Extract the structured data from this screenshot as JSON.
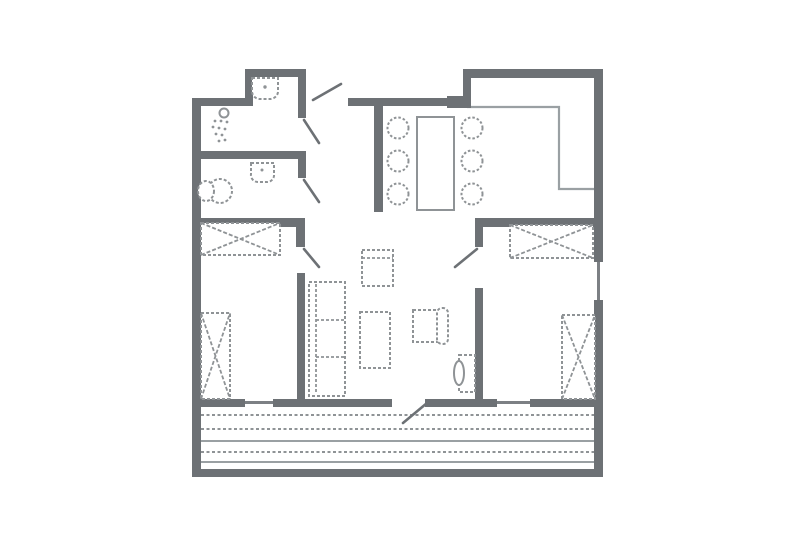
{
  "meta": {
    "title": "apartment-floor-plan",
    "canvas_width": 805,
    "canvas_height": 555,
    "background": "#ffffff"
  },
  "palette": {
    "wall": "#6d7175",
    "wall_light": "#7c8084",
    "furniture": "#8f9396",
    "thin": "#9aa0a3",
    "paper": "#ffffff"
  },
  "floorplan": {
    "walls": [
      {
        "name": "wall-exterior-left",
        "x": 192,
        "y": 98,
        "w": 9,
        "h": 379
      },
      {
        "name": "wall-top-left",
        "x": 192,
        "y": 98,
        "w": 56,
        "h": 8
      },
      {
        "name": "wall-bath-nook-left",
        "x": 245,
        "y": 69,
        "w": 8,
        "h": 37
      },
      {
        "name": "wall-bath-nook-top",
        "x": 245,
        "y": 69,
        "w": 61,
        "h": 8
      },
      {
        "name": "wall-bath-right-upper",
        "x": 298,
        "y": 69,
        "w": 8,
        "h": 49
      },
      {
        "name": "wall-shower-bottom",
        "x": 192,
        "y": 151,
        "w": 114,
        "h": 8
      },
      {
        "name": "wall-wc-right-stub",
        "x": 298,
        "y": 151,
        "w": 8,
        "h": 27
      },
      {
        "name": "wall-bedroom1-top",
        "x": 192,
        "y": 218,
        "w": 112,
        "h": 9
      },
      {
        "name": "wall-bedroom1-right-stub",
        "x": 296,
        "y": 218,
        "w": 9,
        "h": 29
      },
      {
        "name": "wall-living-west",
        "x": 297,
        "y": 273,
        "w": 8,
        "h": 132
      },
      {
        "name": "wall-hall-top",
        "x": 348,
        "y": 98,
        "w": 100,
        "h": 8
      },
      {
        "name": "wall-hall-top-block",
        "x": 447,
        "y": 96,
        "w": 21,
        "h": 12
      },
      {
        "name": "wall-hall-dining",
        "x": 374,
        "y": 98,
        "w": 9,
        "h": 114
      },
      {
        "name": "wall-kitchen-top",
        "x": 463,
        "y": 69,
        "w": 140,
        "h": 9
      },
      {
        "name": "wall-kitchen-left-stub",
        "x": 463,
        "y": 69,
        "w": 8,
        "h": 39
      },
      {
        "name": "wall-exterior-right-upper",
        "x": 594,
        "y": 69,
        "w": 9,
        "h": 193
      },
      {
        "name": "wall-exterior-right-lower",
        "x": 594,
        "y": 300,
        "w": 9,
        "h": 177
      },
      {
        "name": "wall-bedroom2-top",
        "x": 475,
        "y": 218,
        "w": 128,
        "h": 9
      },
      {
        "name": "wall-bedroom2-left-stub",
        "x": 475,
        "y": 218,
        "w": 8,
        "h": 29
      },
      {
        "name": "wall-bedroom2-left",
        "x": 475,
        "y": 288,
        "w": 8,
        "h": 117
      },
      {
        "name": "wall-bottom-seg1",
        "x": 192,
        "y": 399,
        "w": 53,
        "h": 8
      },
      {
        "name": "wall-bottom-seg2",
        "x": 273,
        "y": 399,
        "w": 119,
        "h": 8
      },
      {
        "name": "wall-bottom-seg3",
        "x": 425,
        "y": 399,
        "w": 72,
        "h": 8
      },
      {
        "name": "wall-bottom-seg4",
        "x": 530,
        "y": 399,
        "w": 73,
        "h": 8
      },
      {
        "name": "wall-deck-bottom",
        "x": 192,
        "y": 469,
        "w": 411,
        "h": 8
      }
    ],
    "windows": [
      {
        "name": "window-bottom-left",
        "x": 245,
        "y": 401,
        "w": 28,
        "h": 3
      },
      {
        "name": "window-bottom-right",
        "x": 497,
        "y": 401,
        "w": 33,
        "h": 3
      },
      {
        "name": "window-right-wall",
        "x": 597,
        "y": 262,
        "w": 3,
        "h": 38
      }
    ],
    "door_leaves": [
      {
        "name": "door-entry",
        "x1": 313,
        "y1": 100,
        "x2": 341,
        "y2": 84
      },
      {
        "name": "door-shower-room",
        "x1": 304,
        "y1": 120,
        "x2": 319,
        "y2": 143
      },
      {
        "name": "door-wc",
        "x1": 304,
        "y1": 180,
        "x2": 319,
        "y2": 202
      },
      {
        "name": "door-bedroom1",
        "x1": 304,
        "y1": 249,
        "x2": 319,
        "y2": 267
      },
      {
        "name": "door-bedroom2",
        "x1": 477,
        "y1": 249,
        "x2": 455,
        "y2": 267
      },
      {
        "name": "door-deck",
        "x1": 427,
        "y1": 403,
        "x2": 403,
        "y2": 423
      }
    ],
    "counters": [
      {
        "name": "kitchen-counter-edge",
        "points": "467,107 559,107 559,189 594,189"
      }
    ],
    "deck": {
      "name": "deck-boards",
      "x1": 201,
      "x2": 594,
      "lines": [
        {
          "y": 415,
          "dashed": true
        },
        {
          "y": 429,
          "dashed": true
        },
        {
          "y": 441,
          "dashed": false
        },
        {
          "y": 452,
          "dashed": true
        },
        {
          "y": 462,
          "dashed": false
        }
      ]
    },
    "furniture": [
      {
        "type": "path",
        "name": "shower-room-sink",
        "d": "M252,78 h26 v12 a8,8 0 0 1 -8,9 h-10 a8,8 0 0 1 -8,-9 z",
        "dash": "3 2"
      },
      {
        "type": "dot",
        "name": "shower-room-sink-drain",
        "cx": 265,
        "cy": 87,
        "r": 1.7
      },
      {
        "type": "circle",
        "name": "shower-head-icon",
        "cx": 224,
        "cy": 113,
        "r": 4.5,
        "dash": ""
      },
      {
        "type": "dot",
        "name": "shower-spray-dot",
        "cx": 215,
        "cy": 121,
        "r": 1.4
      },
      {
        "type": "dot",
        "name": "shower-spray-dot",
        "cx": 221,
        "cy": 121,
        "r": 1.4
      },
      {
        "type": "dot",
        "name": "shower-spray-dot",
        "cx": 227,
        "cy": 122,
        "r": 1.4
      },
      {
        "type": "dot",
        "name": "shower-spray-dot",
        "cx": 213,
        "cy": 127,
        "r": 1.4
      },
      {
        "type": "dot",
        "name": "shower-spray-dot",
        "cx": 219,
        "cy": 128,
        "r": 1.4
      },
      {
        "type": "dot",
        "name": "shower-spray-dot",
        "cx": 225,
        "cy": 129,
        "r": 1.4
      },
      {
        "type": "dot",
        "name": "shower-spray-dot",
        "cx": 216,
        "cy": 134,
        "r": 1.4
      },
      {
        "type": "dot",
        "name": "shower-spray-dot",
        "cx": 222,
        "cy": 135,
        "r": 1.4
      },
      {
        "type": "dot",
        "name": "shower-spray-dot",
        "cx": 219,
        "cy": 141,
        "r": 1.4
      },
      {
        "type": "dot",
        "name": "shower-spray-dot",
        "cx": 225,
        "cy": 140,
        "r": 1.4
      },
      {
        "type": "path",
        "name": "wc-sink",
        "d": "M251,163 h23 v11 a7,7 0 0 1 -7,8 h-9 a7,7 0 0 1 -7,-8 z",
        "dash": "3 2"
      },
      {
        "type": "dot",
        "name": "wc-sink-drain",
        "cx": 262,
        "cy": 170,
        "r": 1.5
      },
      {
        "type": "ellipse",
        "name": "toilet-bowl",
        "cx": 220,
        "cy": 191,
        "rx": 12,
        "ry": 12,
        "dash": "3 2"
      },
      {
        "type": "ellipse",
        "name": "toilet-tank",
        "cx": 206,
        "cy": 191,
        "rx": 8,
        "ry": 10,
        "dash": "3 2"
      },
      {
        "type": "wardrobe",
        "name": "wardrobe-bedroom1-top",
        "x": 201,
        "y": 223,
        "w": 79,
        "h": 32
      },
      {
        "type": "wardrobe",
        "name": "wardrobe-bedroom1-side",
        "x": 201,
        "y": 313,
        "w": 29,
        "h": 86
      },
      {
        "type": "wardrobe",
        "name": "wardrobe-bedroom2-top",
        "x": 510,
        "y": 225,
        "w": 83,
        "h": 33
      },
      {
        "type": "wardrobe",
        "name": "wardrobe-bedroom2-side",
        "x": 562,
        "y": 315,
        "w": 33,
        "h": 84
      },
      {
        "type": "rect",
        "name": "sofa",
        "x": 309,
        "y": 282,
        "w": 36,
        "h": 114,
        "dash": "3 2"
      },
      {
        "type": "line",
        "name": "sofa-backrest-line",
        "x1": 316,
        "y1": 284,
        "x2": 316,
        "y2": 394,
        "dash": "3 2"
      },
      {
        "type": "line",
        "name": "sofa-cushion-divider",
        "x1": 316,
        "y1": 320,
        "x2": 345,
        "y2": 320,
        "dash": "3 2"
      },
      {
        "type": "line",
        "name": "sofa-cushion-divider",
        "x1": 316,
        "y1": 357,
        "x2": 345,
        "y2": 357,
        "dash": "3 2"
      },
      {
        "type": "rect",
        "name": "coffee-table",
        "x": 360,
        "y": 312,
        "w": 30,
        "h": 56,
        "dash": "3 2"
      },
      {
        "type": "rect",
        "name": "armchair-north",
        "x": 362,
        "y": 250,
        "w": 31,
        "h": 36,
        "dash": "3 2"
      },
      {
        "type": "line",
        "name": "armchair-north-backrest",
        "x1": 362,
        "y1": 258,
        "x2": 393,
        "y2": 258,
        "dash": "3 2"
      },
      {
        "type": "rect",
        "name": "armchair-east-seat",
        "x": 413,
        "y": 310,
        "w": 27,
        "h": 32,
        "dash": "3 2"
      },
      {
        "type": "rrect",
        "name": "armchair-east-backrest",
        "x": 437,
        "y": 308,
        "w": 11,
        "h": 36,
        "rx": 5,
        "dash": "3 2"
      },
      {
        "type": "rect",
        "name": "dining-table",
        "x": 417,
        "y": 117,
        "w": 37,
        "h": 93,
        "dash": ""
      },
      {
        "type": "circle",
        "name": "dining-chair",
        "cx": 398,
        "cy": 128,
        "r": 10.5,
        "dash": "2.5 2"
      },
      {
        "type": "circle",
        "name": "dining-chair",
        "cx": 398,
        "cy": 161,
        "r": 10.5,
        "dash": "2.5 2"
      },
      {
        "type": "circle",
        "name": "dining-chair",
        "cx": 398,
        "cy": 194,
        "r": 10.5,
        "dash": "2.5 2"
      },
      {
        "type": "circle",
        "name": "dining-chair",
        "cx": 472,
        "cy": 128,
        "r": 10.5,
        "dash": "2.5 2"
      },
      {
        "type": "circle",
        "name": "dining-chair",
        "cx": 472,
        "cy": 161,
        "r": 10.5,
        "dash": "2.5 2"
      },
      {
        "type": "circle",
        "name": "dining-chair",
        "cx": 472,
        "cy": 194,
        "r": 10.5,
        "dash": "2.5 2"
      },
      {
        "type": "rect",
        "name": "tv-cabinet",
        "x": 459,
        "y": 355,
        "w": 16,
        "h": 37,
        "dash": "3 2"
      },
      {
        "type": "ellipse",
        "name": "tv-screen",
        "cx": 459,
        "cy": 373,
        "rx": 5,
        "ry": 12,
        "dash": ""
      }
    ]
  }
}
